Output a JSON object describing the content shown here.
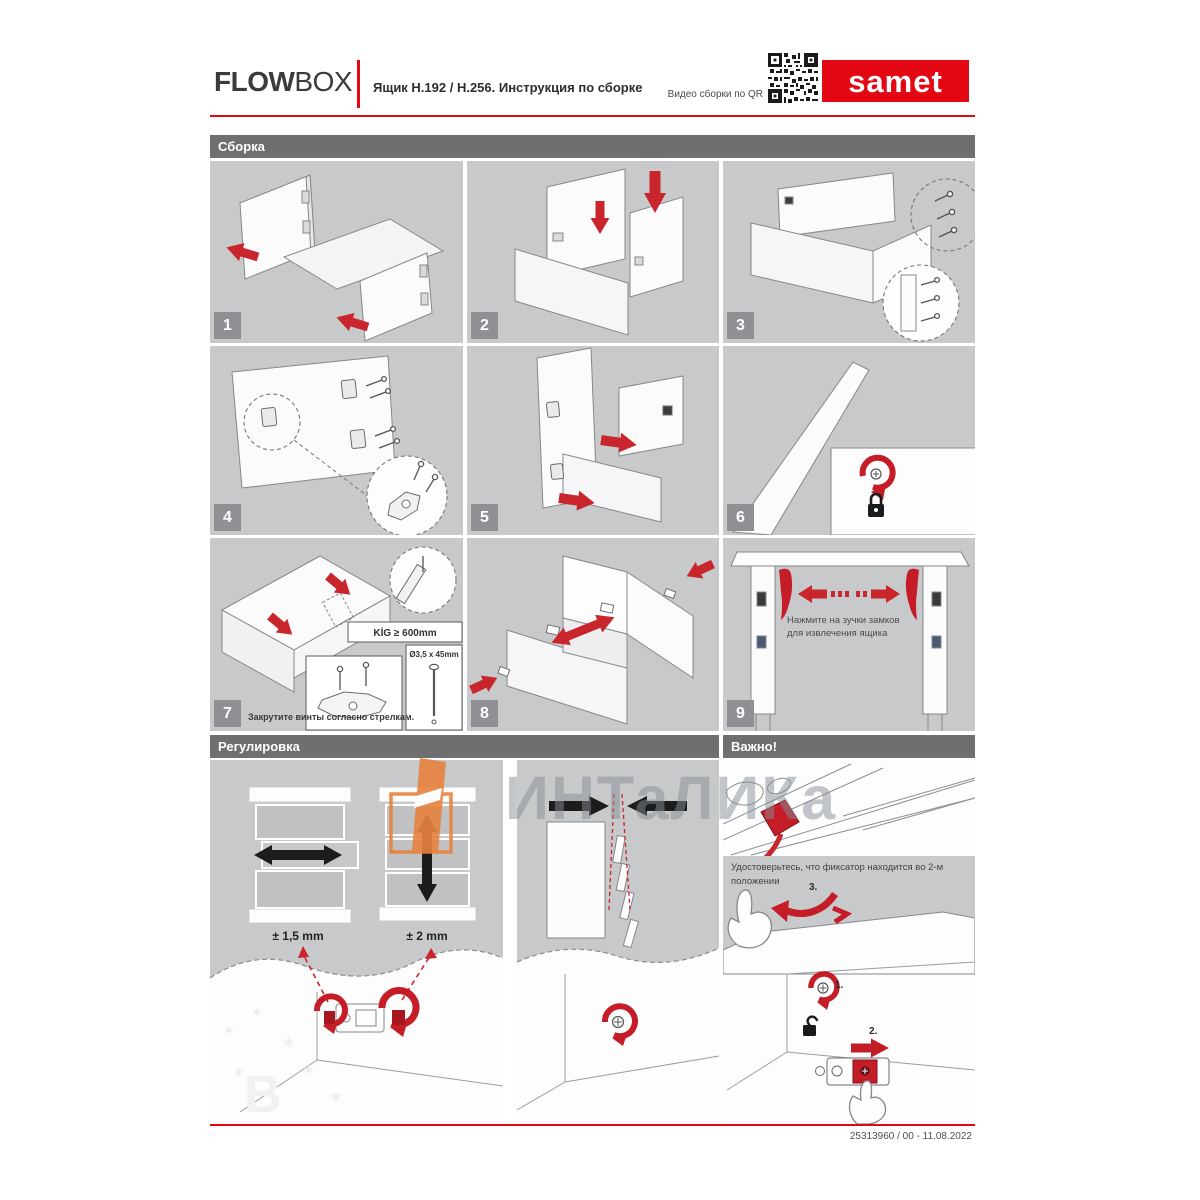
{
  "header": {
    "brand_bold": "FLOW",
    "brand_light": "BOX",
    "title": "Ящик Н.192 / Н.256. Инструкция по сборке",
    "qr_caption": "Видео сборки по QR",
    "logo_text": "samet"
  },
  "sections": {
    "assembly": "Сборка",
    "adjustment": "Регулировка",
    "important": "Важно!"
  },
  "steps": [
    "1",
    "2",
    "3",
    "4",
    "5",
    "6",
    "7",
    "8",
    "9"
  ],
  "step7": {
    "kig_label": "KİG ≥ 600mm",
    "screw_label": "Ø3,5 x 45mm",
    "caption": "Закрутите винты согласно стрелкам."
  },
  "step9": {
    "note": "Нажмите на зучки замков для извлечения ящика"
  },
  "adjustment_labels": {
    "horizontal": "± 1,5 mm",
    "vertical": "± 2 mm"
  },
  "important_panel": {
    "note": "Удостоверьтесь, что фиксатор находится во 2-м положении",
    "marker_1": "1.",
    "marker_2": "2.",
    "marker_3": "3."
  },
  "watermark": {
    "text": "ИНТаЛИКа"
  },
  "footer": {
    "doc_number": "25313960 / 00 - 11.08.2022"
  },
  "colors": {
    "accent_red": "#e30613",
    "arrow_red": "#c9252c",
    "panel_gray": "#c8c9cb",
    "section_bar_gray": "#6e6f71",
    "badge_gray": "#8f9093",
    "watermark_orange": "#e8813f"
  }
}
